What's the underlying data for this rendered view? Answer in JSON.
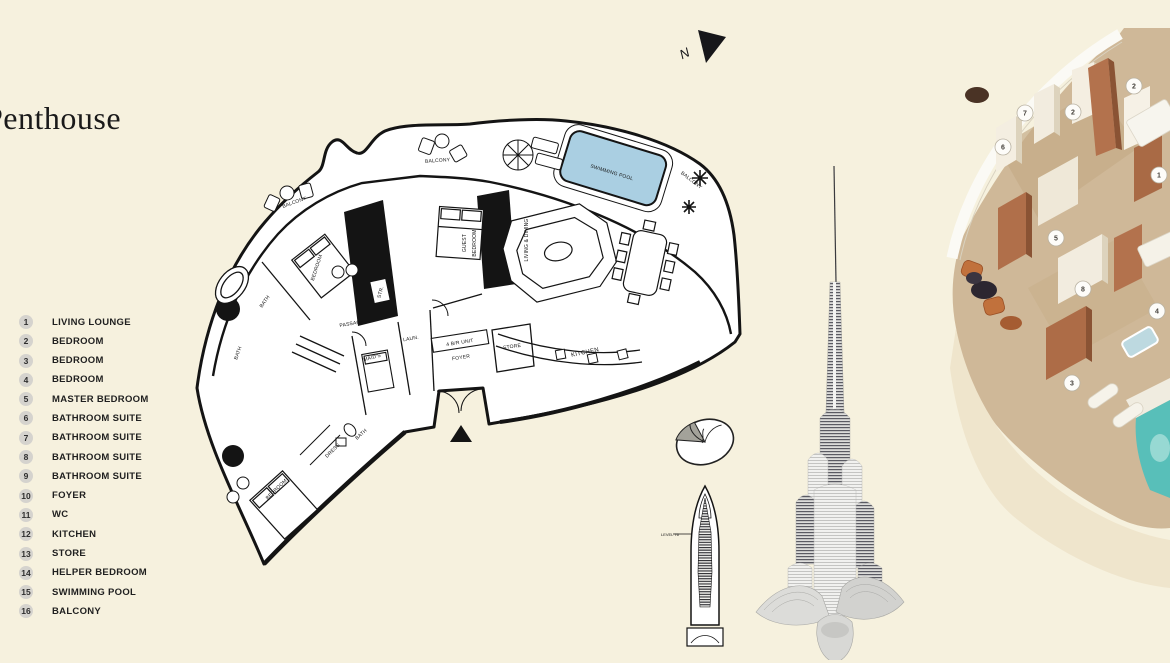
{
  "page": {
    "bg": "#f6f1de"
  },
  "header": {
    "title": "Penthouse"
  },
  "north": {
    "label": "N"
  },
  "legend": {
    "items": [
      {
        "num": "1",
        "label": "LIVING LOUNGE"
      },
      {
        "num": "2",
        "label": "BEDROOM"
      },
      {
        "num": "3",
        "label": "BEDROOM"
      },
      {
        "num": "4",
        "label": "BEDROOM"
      },
      {
        "num": "5",
        "label": "MASTER BEDROOM"
      },
      {
        "num": "6",
        "label": "BATHROOM SUITE"
      },
      {
        "num": "7",
        "label": "BATHROOM SUITE"
      },
      {
        "num": "8",
        "label": "BATHROOM SUITE"
      },
      {
        "num": "9",
        "label": "BATHROOM SUITE"
      },
      {
        "num": "10",
        "label": "FOYER"
      },
      {
        "num": "11",
        "label": "WC"
      },
      {
        "num": "12",
        "label": "KITCHEN"
      },
      {
        "num": "13",
        "label": "STORE"
      },
      {
        "num": "14",
        "label": "HELPER BEDROOM"
      },
      {
        "num": "15",
        "label": "SWIMMING POOL"
      },
      {
        "num": "16",
        "label": "BALCONY"
      }
    ]
  },
  "floor_plan": {
    "pool_fill": "#aacfe2",
    "labels": {
      "balcony_left": "BALCONY",
      "balcony_top": "BALCONY",
      "balcony_right": "BALCONY",
      "swimming_pool": "SWIMMING POOL",
      "bedroom_top": "BEDROOM",
      "guest_1": "GUEST",
      "guest_2": "BEDROOM",
      "living_dining": "LIVING & DINING",
      "passage": "PASSAGE",
      "bath_top": "BATH",
      "bath_left": "BATH",
      "bath_mid": "BATH",
      "str": "STR.",
      "laun": "LAUN.",
      "maids": "MAID'S",
      "foyer_unit": "4 B/R UNIT",
      "foyer": "FOYER",
      "store": "STORE",
      "kitchen": "KITCHEN",
      "dress": "DRESS",
      "bedroom_bottom": "BEDROOM"
    }
  },
  "tower_icon": {
    "level_label": "LEVEL 76"
  },
  "render": {
    "sand": "#cfb898",
    "copper": "#b06f4a",
    "pool": "#58bfb9",
    "badges": [
      "7",
      "6",
      "2",
      "2",
      "1",
      "5",
      "8",
      "4",
      "3"
    ]
  }
}
